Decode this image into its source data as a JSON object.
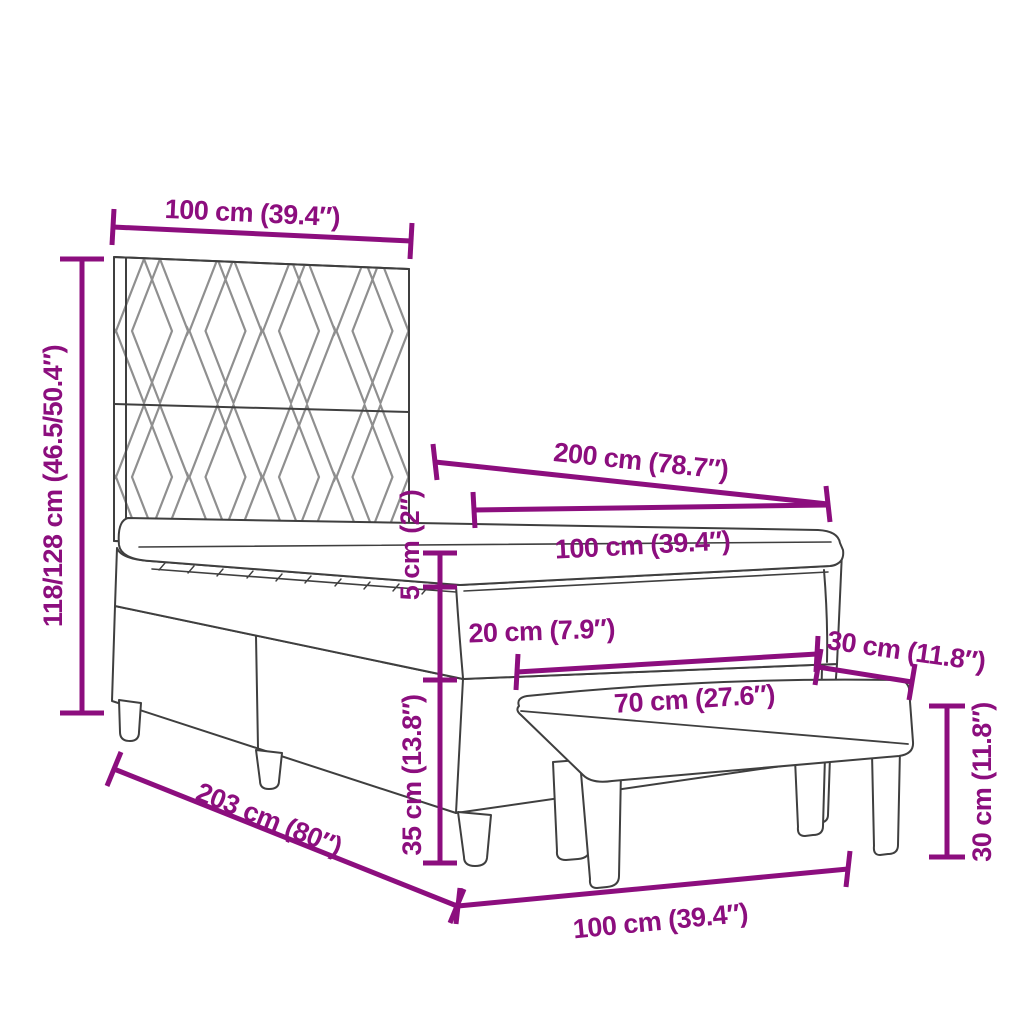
{
  "figure": {
    "kind": "product-dimension-diagram",
    "subject": "box spring bed with patterned headboard, mattress topper and upholstered bench",
    "background_color": "#ffffff",
    "dimension_color": "#8C0E7E",
    "outline_color": "#3f3f3f",
    "pattern_color": "#8f8f8f"
  },
  "dims": {
    "headboard_width": "100 cm (39.4″)",
    "total_height": "118/128 cm (46.5/50.4″)",
    "bed_length": "200 cm (78.7″)",
    "mattress_width": "100 cm (39.4″)",
    "topper_height": "5 cm (2″)",
    "mattress_height": "20 cm (7.9″)",
    "bench_depth": "30 cm (11.8″)",
    "bench_length": "70 cm (27.6″)",
    "base_height": "35 cm (13.8″)",
    "frame_length": "203 cm (80″)",
    "base_width": "100 cm (39.4″)",
    "bench_height": "30 cm (11.8″)"
  }
}
